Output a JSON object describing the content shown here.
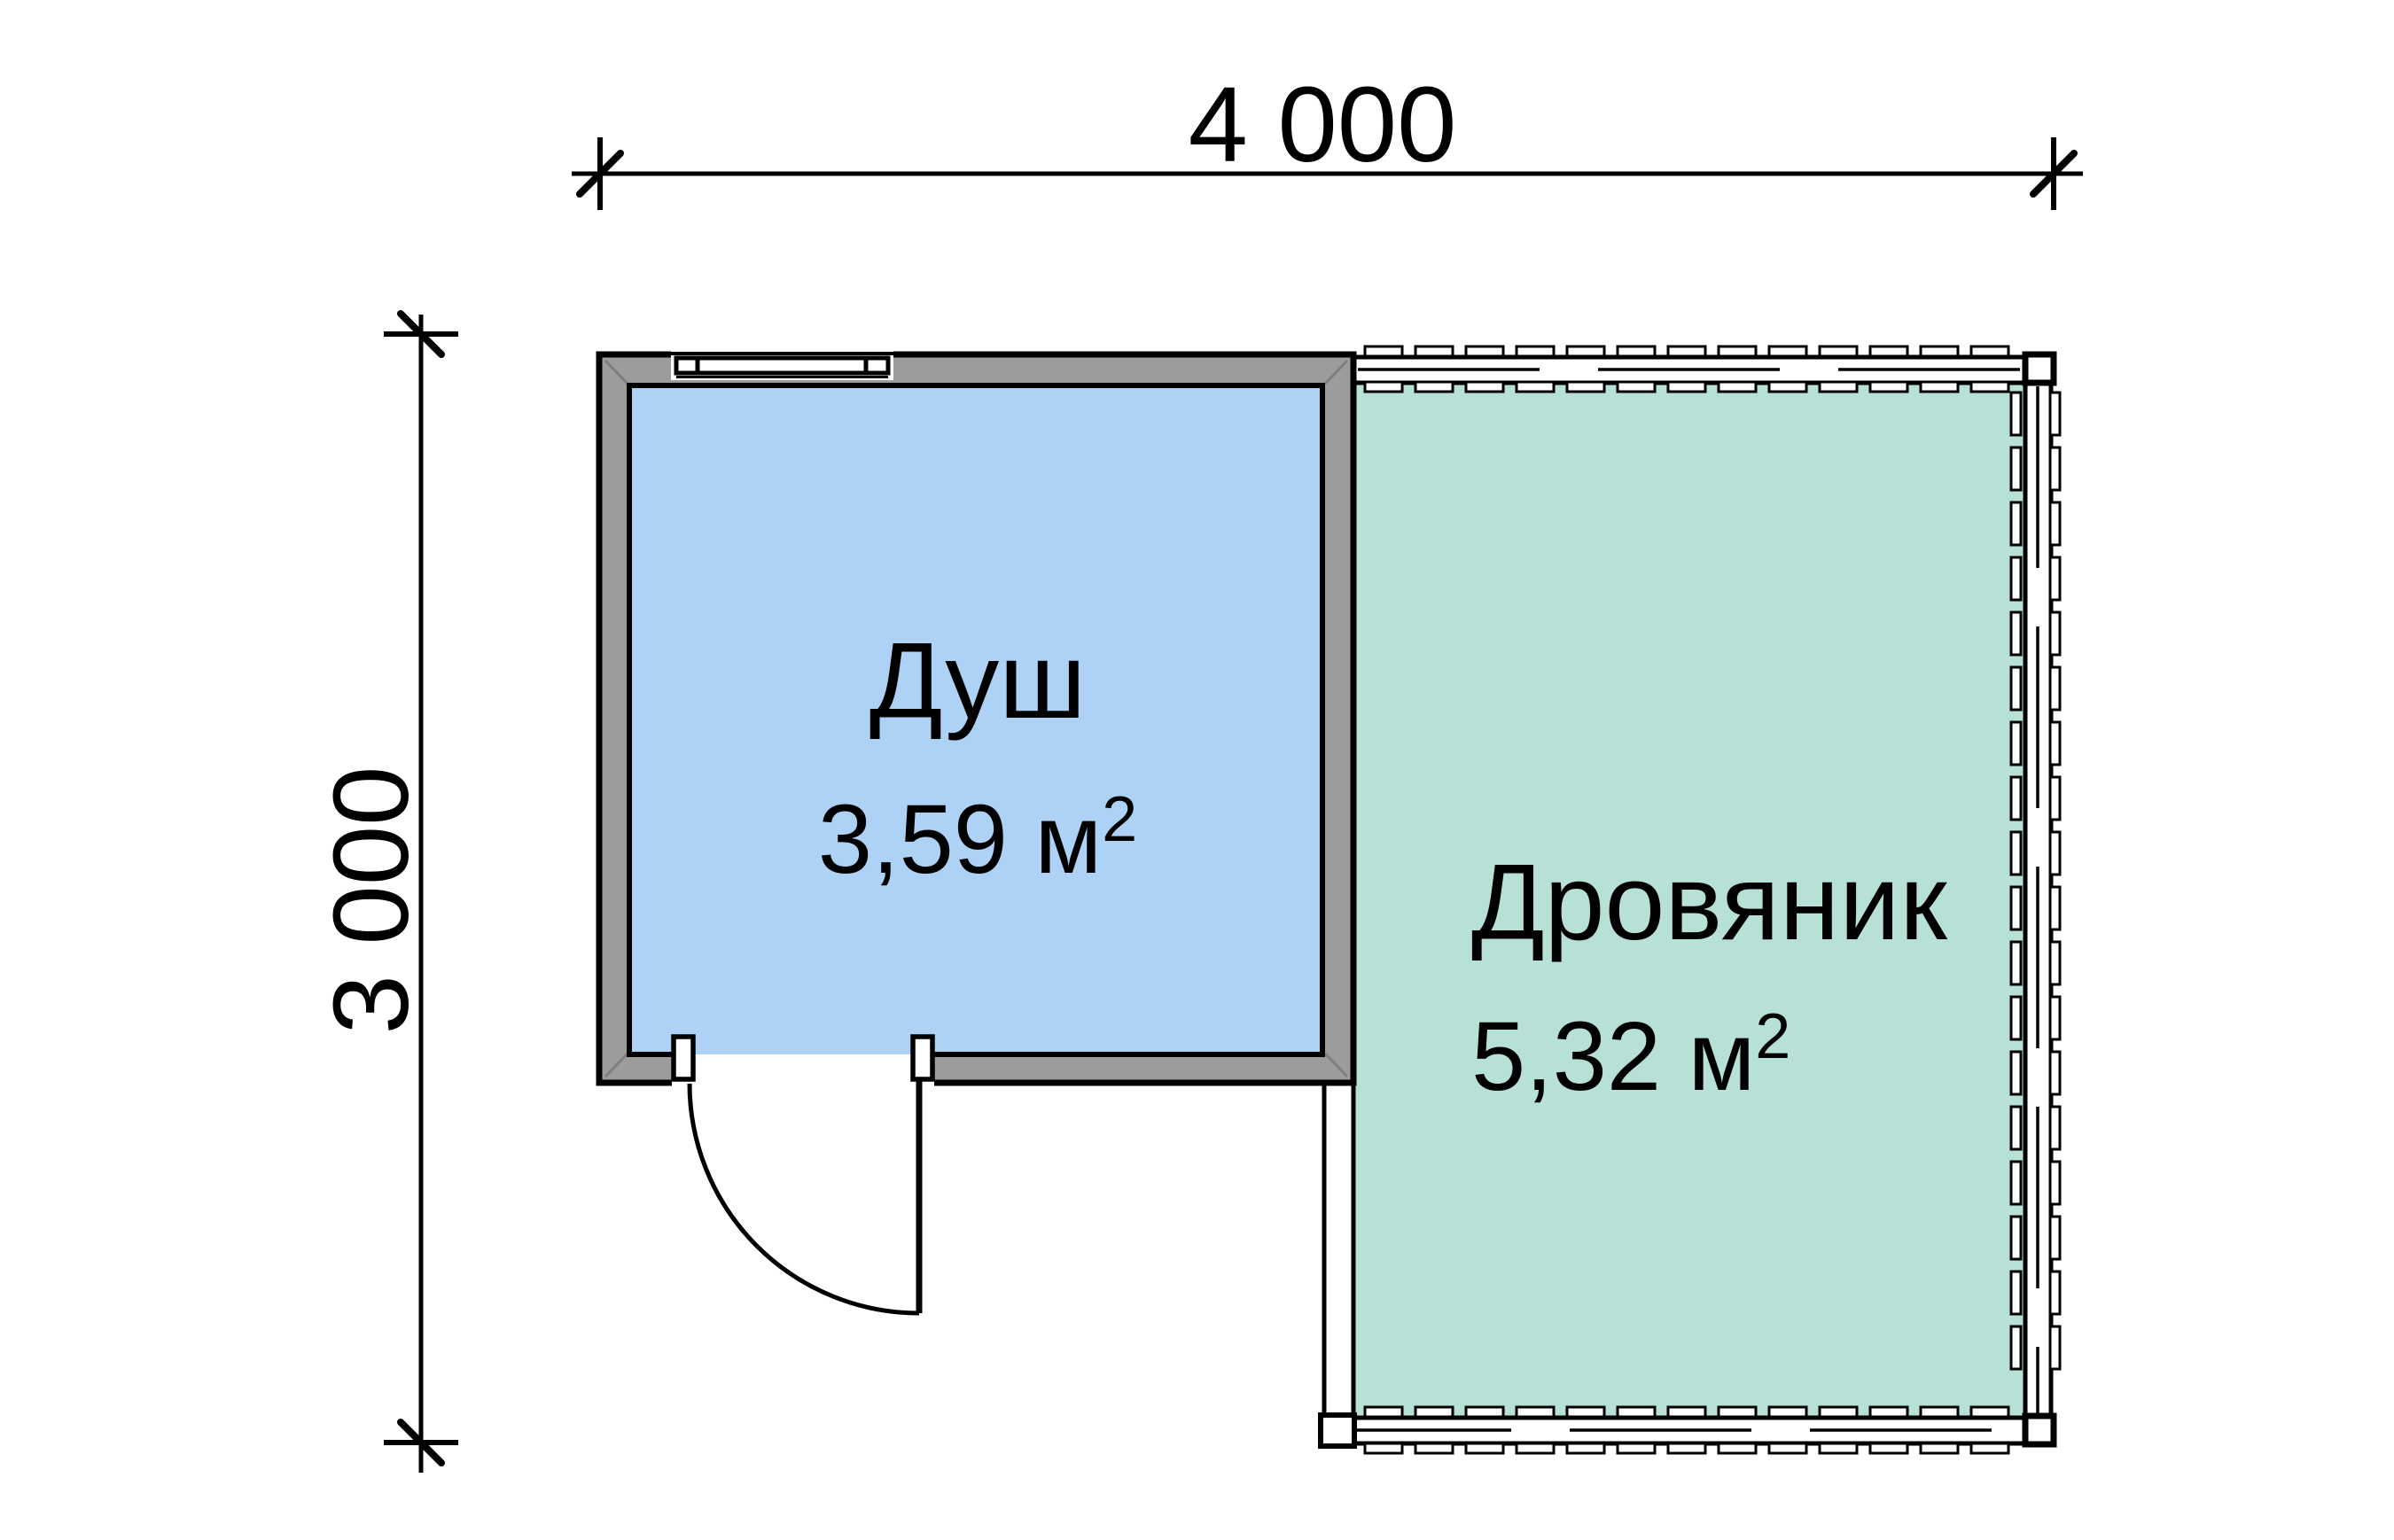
{
  "dimensions": {
    "width_label": "4 000",
    "height_label": "3 000"
  },
  "rooms": [
    {
      "name": "Душ",
      "area_value": "3,59 м",
      "area_sup": "2",
      "fill": "#aed2f5"
    },
    {
      "name": "Дровяник",
      "area_value": "5,32 м",
      "area_sup": "2",
      "fill": "#b7e0d6"
    }
  ],
  "colors": {
    "wall_gray": "#9c9c9c",
    "line": "#000000",
    "background": "#ffffff"
  }
}
